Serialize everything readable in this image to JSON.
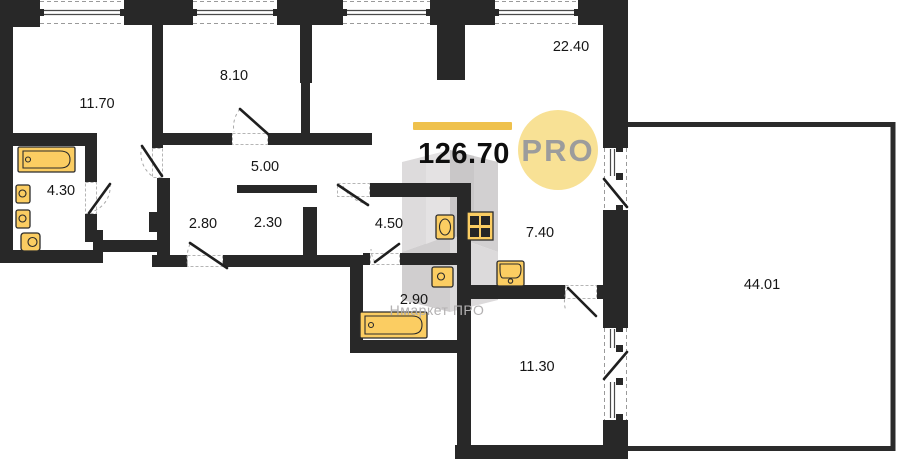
{
  "summary": {
    "total_area": "126.70",
    "badge": "PRO"
  },
  "watermark": {
    "text": "Нмаркет ПРО"
  },
  "colors": {
    "wall": "#282828",
    "fixture": "#FBCD62",
    "accent_bar": "#EFC14C",
    "badge_bg": "#F8E195",
    "badge_text": "#9C9C9C",
    "watermark_text": "#B3B1B2"
  },
  "rooms": [
    {
      "id": "11-70",
      "area": "11.70",
      "x": 97,
      "y": 108
    },
    {
      "id": "8-10",
      "area": "8.10",
      "x": 234,
      "y": 80
    },
    {
      "id": "22-40",
      "area": "22.40",
      "x": 571,
      "y": 51
    },
    {
      "id": "4-30",
      "area": "4.30",
      "x": 61,
      "y": 195
    },
    {
      "id": "5-00",
      "area": "5.00",
      "x": 265,
      "y": 171
    },
    {
      "id": "2-80",
      "area": "2.80",
      "x": 203,
      "y": 228
    },
    {
      "id": "2-30",
      "area": "2.30",
      "x": 268,
      "y": 227
    },
    {
      "id": "4-50",
      "area": "4.50",
      "x": 389,
      "y": 228
    },
    {
      "id": "7-40",
      "area": "7.40",
      "x": 540,
      "y": 237
    },
    {
      "id": "2-90",
      "area": "2.90",
      "x": 414,
      "y": 304
    },
    {
      "id": "11-30",
      "area": "11.30",
      "x": 537,
      "y": 371
    },
    {
      "id": "44-01",
      "area": "44.01",
      "x": 762,
      "y": 289
    }
  ]
}
